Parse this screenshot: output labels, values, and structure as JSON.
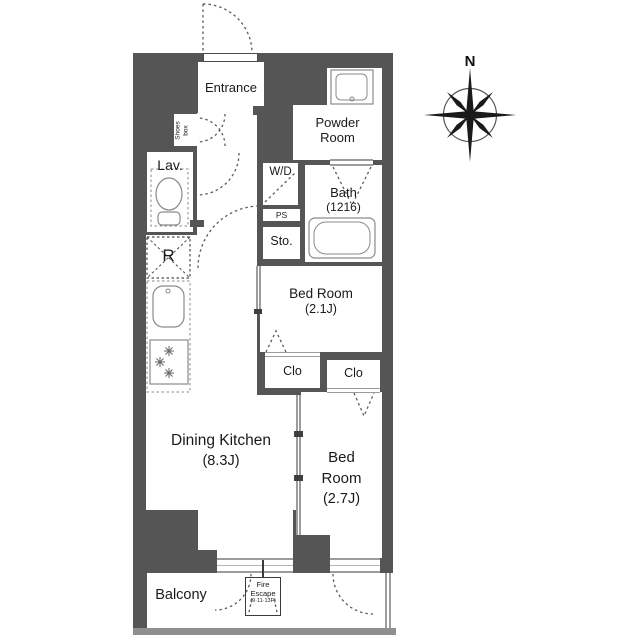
{
  "colors": {
    "wall": "#555555",
    "window_line": "#9c9c9c",
    "balcony_rail": "#8f8f8f",
    "dash_line": "#5a5a5a",
    "fixture_line": "#888888",
    "text": "#1a1a1a"
  },
  "compass": {
    "north_label": "N"
  },
  "rooms": {
    "entrance": {
      "label": "Entrance"
    },
    "shoes_box": {
      "line1": "Shoes",
      "line2": "box"
    },
    "powder_room": {
      "line1": "Powder",
      "line2": "Room"
    },
    "bath": {
      "name": "Bath",
      "size": "(1216)"
    },
    "lavatory": {
      "label": "Lav."
    },
    "washer_dryer": {
      "label": "W/D"
    },
    "pipe_space": {
      "label": "PS"
    },
    "storage": {
      "label": "Sto."
    },
    "refrigerator": {
      "label": "R"
    },
    "bedroom_1": {
      "name": "Bed Room",
      "size": "(2.1J)"
    },
    "closet_1": {
      "label": "Clo"
    },
    "closet_2": {
      "label": "Clo"
    },
    "dining_kitchen": {
      "name": "Dining Kitchen",
      "size": "(8.3J)"
    },
    "bedroom_2": {
      "line1": "Bed",
      "line2": "Room",
      "size": "(2.7J)"
    },
    "balcony": {
      "label": "Balcony"
    },
    "fire_escape": {
      "line1": "Fire",
      "line2": "Escape",
      "line3": "(9·11·13F)"
    }
  }
}
